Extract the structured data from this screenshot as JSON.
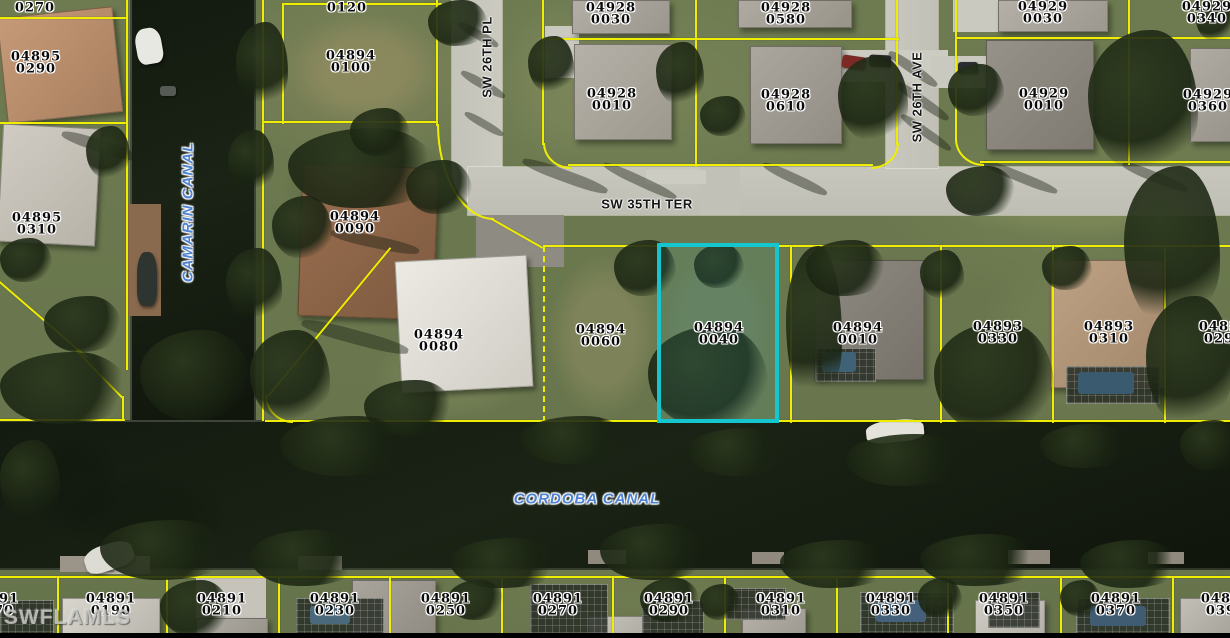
{
  "map": {
    "watermark": "SWFLAMLS",
    "streets": [
      {
        "name": "SW 26TH PL",
        "cx": 487,
        "cy": 57,
        "vertical": true
      },
      {
        "name": "SW 35TH TER",
        "cx": 647,
        "cy": 204,
        "vertical": false
      },
      {
        "name": "SW 26TH AVE",
        "cx": 917,
        "cy": 97,
        "vertical": true
      }
    ],
    "canals": [
      {
        "name": "CAMARIN CANAL",
        "cx": 188,
        "cy": 212,
        "vertical": true
      },
      {
        "name": "CORDOBA CANAL",
        "cx": 587,
        "cy": 499,
        "vertical": false
      }
    ],
    "highlighted_parcel": {
      "id": "04894 0040",
      "color": "#14c6ce"
    },
    "colors": {
      "parcel_line": "#f0ee00",
      "highlight": "#14c6ce",
      "canal_label": "#4f83d4",
      "water": "#141a10",
      "street": "#c6c5bb",
      "grass": "#6e7b51"
    },
    "parcels": [
      {
        "line1": "0270",
        "line2": "",
        "cx": 35,
        "cy": 8
      },
      {
        "line1": "04895",
        "line2": "0290",
        "cx": 36,
        "cy": 63
      },
      {
        "line1": "04895",
        "line2": "0310",
        "cx": 37,
        "cy": 224
      },
      {
        "line1": "0120",
        "line2": "",
        "cx": 347,
        "cy": 8
      },
      {
        "line1": "04894",
        "line2": "0100",
        "cx": 351,
        "cy": 62
      },
      {
        "line1": "04894",
        "line2": "0090",
        "cx": 355,
        "cy": 223
      },
      {
        "line1": "04894",
        "line2": "0080",
        "cx": 439,
        "cy": 341
      },
      {
        "line1": "04894",
        "line2": "0060",
        "cx": 601,
        "cy": 336
      },
      {
        "line1": "04894",
        "line2": "0040",
        "cx": 719,
        "cy": 334
      },
      {
        "line1": "04894",
        "line2": "0010",
        "cx": 858,
        "cy": 334
      },
      {
        "line1": "04893",
        "line2": "0330",
        "cx": 998,
        "cy": 333
      },
      {
        "line1": "04893",
        "line2": "0310",
        "cx": 1109,
        "cy": 333
      },
      {
        "line1": "04893",
        "line2": "0290",
        "cx": 1224,
        "cy": 333
      },
      {
        "line1": "04928",
        "line2": "0030",
        "cx": 611,
        "cy": 14
      },
      {
        "line1": "04928",
        "line2": "0580",
        "cx": 786,
        "cy": 14
      },
      {
        "line1": "04928",
        "line2": "0010",
        "cx": 612,
        "cy": 100
      },
      {
        "line1": "04928",
        "line2": "0610",
        "cx": 786,
        "cy": 101
      },
      {
        "line1": "04929",
        "line2": "0030",
        "cx": 1043,
        "cy": 13
      },
      {
        "line1": "04929",
        "line2": "0340",
        "cx": 1207,
        "cy": 13
      },
      {
        "line1": "04929",
        "line2": "0010",
        "cx": 1044,
        "cy": 100
      },
      {
        "line1": "04929",
        "line2": "0360",
        "cx": 1208,
        "cy": 101
      },
      {
        "line1": "04891",
        "line2": "0170",
        "cx": -6,
        "cy": 605
      },
      {
        "line1": "04891",
        "line2": "0190",
        "cx": 111,
        "cy": 605
      },
      {
        "line1": "04891",
        "line2": "0210",
        "cx": 222,
        "cy": 605
      },
      {
        "line1": "04891",
        "line2": "0230",
        "cx": 335,
        "cy": 605
      },
      {
        "line1": "04891",
        "line2": "0250",
        "cx": 446,
        "cy": 605
      },
      {
        "line1": "04891",
        "line2": "0270",
        "cx": 558,
        "cy": 605
      },
      {
        "line1": "04891",
        "line2": "0290",
        "cx": 669,
        "cy": 605
      },
      {
        "line1": "04891",
        "line2": "0310",
        "cx": 781,
        "cy": 605
      },
      {
        "line1": "04891",
        "line2": "0330",
        "cx": 891,
        "cy": 605
      },
      {
        "line1": "04891",
        "line2": "0350",
        "cx": 1004,
        "cy": 605
      },
      {
        "line1": "04891",
        "line2": "0370",
        "cx": 1116,
        "cy": 605
      },
      {
        "line1": "04891",
        "line2": "0390",
        "cx": 1226,
        "cy": 605
      }
    ]
  }
}
